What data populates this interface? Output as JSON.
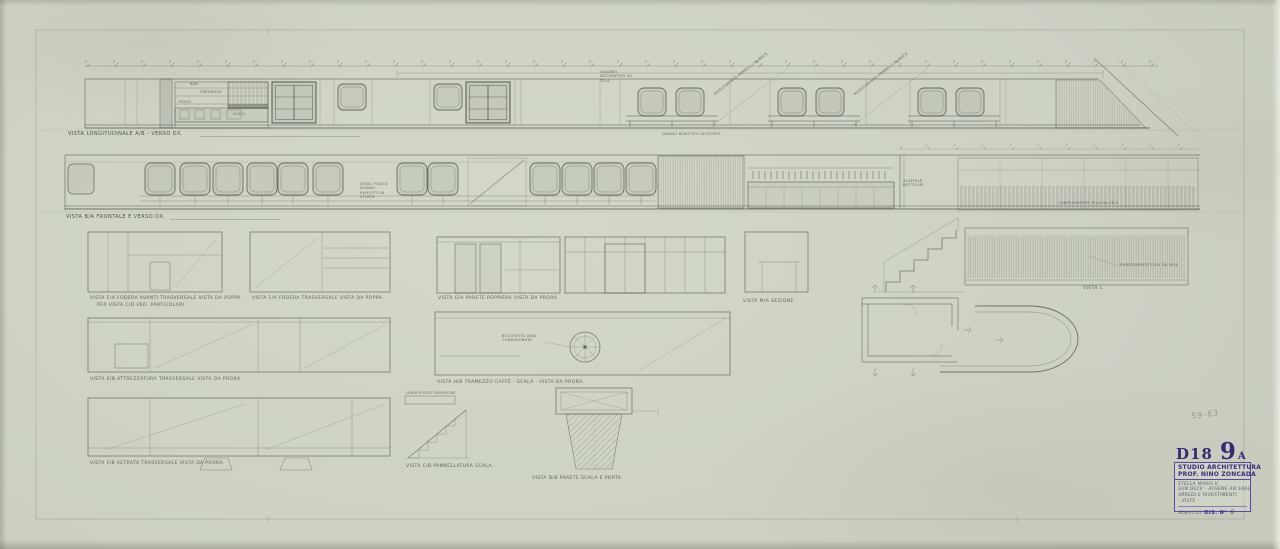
{
  "sheet": {
    "stamp": {
      "code": "D18",
      "number": "9",
      "suffix": "A"
    },
    "title_block": {
      "studio_line1": "STUDIO ARCHITETTURA",
      "studio_line2": "PROF. NINO ZONCADA",
      "project_line1": "STELLA MARIS II",
      "project_line2": "SUN DECK - ATHENE AN SAAL",
      "project_line3": "ARREDI E RIVESTIMENTI",
      "project_line4": "- VISTE -",
      "scale_label": "SCALA 1:25",
      "dis_label": "DIS. N°",
      "dis_number": "9"
    },
    "pencil_note": "59-63",
    "colors": {
      "paper": "#ccd1c4",
      "ink": "#454a3f",
      "stamp_purple": "#3a2d7d"
    }
  },
  "captions": {
    "elevation_top": "VISTA LONGITUDINALE A/B - VERSO DX.",
    "elevation_front": "VISTA B/A FRONTALE E VERSO DX.",
    "panel_ea_1": "VISTA E/A FODERA AVANTI TRASVERSALE VISTA DA POPPA",
    "panel_ea_2": "PER VISTA C/D VED. PARTICOLARI.",
    "panel_fa": "VISTA F/A FODERA TRASVERSALE VISTA DA POPPA.",
    "panel_ga": "VISTA G/A PARETE POPPIERA VISTA DA PRORA.",
    "panel_ma": "VISTA M/A SEZIONE.",
    "panel_l": "VISTA L.",
    "panel_eb": "VISTA E/B ATTREZZATURA TRASVERSALE VISTA DA PRORA.",
    "panel_hb": "VISTA H/B TRAMEZZO CAFFÈ - SCALA - VISTA DA PRORA.",
    "panel_fb": "VISTA F/B VETRATA TRASVERSALE VISTA DA PRORA.",
    "panel_cb": "VISTA C/B PANNELLATURA SCALA.",
    "panel_db": "VISTA D/B PARETE SCALA E PORTA."
  },
  "annotations": {
    "bar": "BAR.",
    "credenza": "CREDENZA",
    "frigo": "FRIGO",
    "dolci": "DOLCI",
    "quadro": "QUADRO DECORATIVO SU TELA",
    "divano": "DIVANO RIVESTITO IN STOFFA",
    "pannello": "RIVESTIMENTO PANNELLI IN NOCE",
    "sedili": "SEDILI FISSI A DIVANO RIVESTITI IN STOFFA",
    "bottiglie": "SCAFFALE BOTTIGLIE",
    "controparete": "CONTROPARETE TELA DA VELE",
    "rivestimento": "RIVESTIMENTO TELA DA VELE",
    "bocchetta": "BOCCHETTA ARIA CONDIZIONATA",
    "linea_ponte": "LINEA PONTE SUPERIORE"
  }
}
